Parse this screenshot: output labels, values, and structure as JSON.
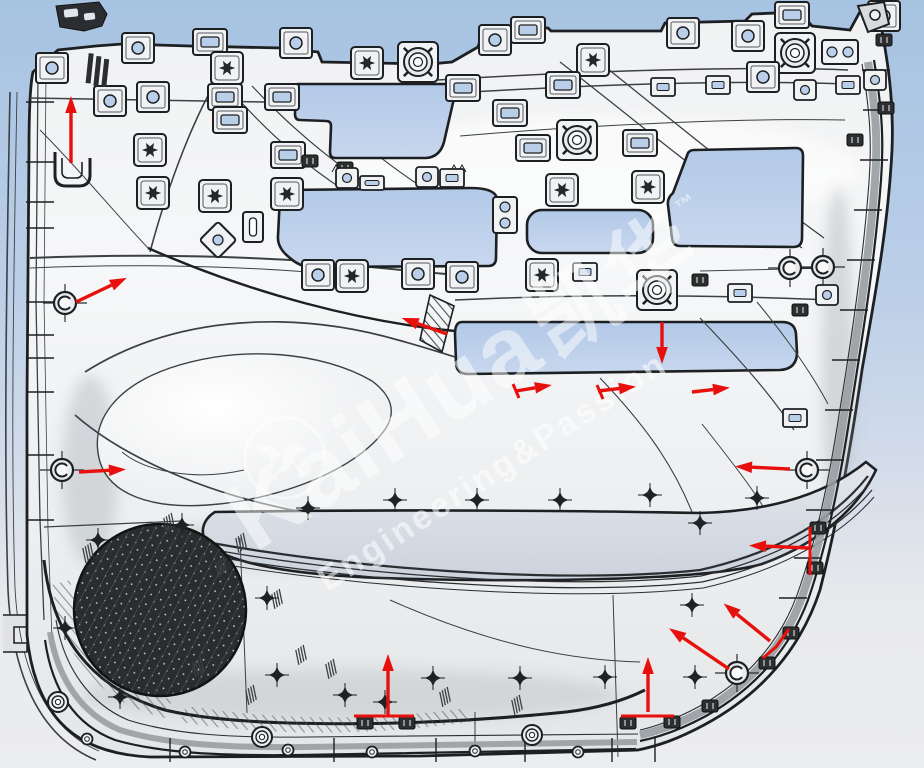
{
  "canvas": {
    "width": 924,
    "height": 768
  },
  "colors": {
    "background_top": "#a6c3e2",
    "background_mid": "#bccfe8",
    "background_bottom": "#ebecee",
    "panel_light": "#f5f6f7",
    "panel_mid": "#e6e8ea",
    "line_dark": "#1d2023",
    "line_mid": "#3c4043",
    "cutout_blue_top": "#b2c9e7",
    "cutout_blue_bottom": "#c8d7ee",
    "pocket_gray": "#dde2e9",
    "arrow_red": "#e8100c",
    "rim_gray": "#989da2",
    "speaker_dark": "#2a2c2e",
    "watermark_white": "#ffffff",
    "clip_blue": "#b9cfe9"
  },
  "watermark": {
    "brand_latin": "KaiHua",
    "brand_cjk": "凯华",
    "trademark": "™",
    "tagline": "Engineering&Passion",
    "logo_name": "hummingbird-logo"
  },
  "drawing": {
    "type": "cad-door-trim-panel-rear-view",
    "speaker": {
      "cx": 160,
      "cy": 610,
      "r": 86
    },
    "arrows": [
      [
        71,
        163,
        71,
        108
      ],
      [
        76,
        302,
        116,
        283
      ],
      [
        79,
        472,
        114,
        470
      ],
      [
        447,
        334,
        413,
        322
      ],
      [
        662,
        322,
        662,
        352
      ],
      [
        516,
        391,
        540,
        387
      ],
      [
        598,
        391,
        624,
        388
      ],
      [
        692,
        392,
        718,
        389
      ],
      [
        790,
        469,
        747,
        467
      ],
      [
        809,
        548,
        761,
        546
      ],
      [
        770,
        641,
        733,
        611
      ],
      [
        729,
        669,
        679,
        635
      ],
      [
        648,
        712,
        648,
        669
      ],
      [
        388,
        716,
        388,
        666
      ]
    ],
    "red_marks": [
      [
        354,
        716,
        414,
        716
      ],
      [
        621,
        716,
        674,
        716
      ],
      [
        810,
        527,
        810,
        575
      ],
      [
        513,
        384,
        519,
        398
      ],
      [
        597,
        385,
        603,
        399
      ]
    ],
    "red_arc": [
      763,
      658,
      776,
      647,
      789,
      629
    ],
    "clips": [
      [
        52,
        68,
        "c"
      ],
      [
        138,
        48,
        "c"
      ],
      [
        210,
        42,
        "r"
      ],
      [
        296,
        43,
        "c"
      ],
      [
        367,
        63,
        "s"
      ],
      [
        418,
        62,
        "t"
      ],
      [
        495,
        40,
        "c"
      ],
      [
        528,
        30,
        "r"
      ],
      [
        593,
        60,
        "s"
      ],
      [
        683,
        33,
        "c"
      ],
      [
        748,
        36,
        "c"
      ],
      [
        792,
        15,
        "r"
      ],
      [
        795,
        53,
        "t"
      ],
      [
        840,
        52,
        "2h"
      ],
      [
        884,
        16,
        "c"
      ],
      [
        110,
        101,
        "c"
      ],
      [
        153,
        97,
        "c"
      ],
      [
        227,
        68,
        "s"
      ],
      [
        225,
        97,
        "r"
      ],
      [
        282,
        97,
        "r"
      ],
      [
        463,
        88,
        "r"
      ],
      [
        563,
        85,
        "r"
      ],
      [
        663,
        87,
        "r2"
      ],
      [
        718,
        85,
        "r2"
      ],
      [
        763,
        77,
        "c"
      ],
      [
        805,
        90,
        "c2"
      ],
      [
        848,
        85,
        "r2"
      ],
      [
        875,
        80,
        "c2"
      ],
      [
        150,
        150,
        "s"
      ],
      [
        230,
        120,
        "r"
      ],
      [
        288,
        155,
        "r"
      ],
      [
        310,
        161,
        "f"
      ],
      [
        345,
        168,
        "f"
      ],
      [
        510,
        113,
        "r"
      ],
      [
        533,
        148,
        "r"
      ],
      [
        577,
        140,
        "t"
      ],
      [
        640,
        143,
        "r"
      ],
      [
        153,
        193,
        "s"
      ],
      [
        215,
        196,
        "s"
      ],
      [
        287,
        194,
        "s"
      ],
      [
        562,
        190,
        "s"
      ],
      [
        648,
        187,
        "s"
      ],
      [
        253,
        227,
        "slotV"
      ],
      [
        218,
        240,
        "d"
      ],
      [
        505,
        215,
        "2v"
      ],
      [
        347,
        178,
        "c2"
      ],
      [
        372,
        183,
        "slotH"
      ],
      [
        427,
        177,
        "c2"
      ],
      [
        452,
        178,
        "r2"
      ],
      [
        318,
        275,
        "c"
      ],
      [
        352,
        276,
        "s"
      ],
      [
        418,
        274,
        "c"
      ],
      [
        462,
        277,
        "c"
      ],
      [
        542,
        275,
        "s"
      ],
      [
        585,
        272,
        "r2"
      ],
      [
        657,
        290,
        "t"
      ],
      [
        740,
        293,
        "r2"
      ],
      [
        700,
        280,
        "f"
      ],
      [
        827,
        295,
        "c2"
      ],
      [
        800,
        310,
        "f"
      ],
      [
        795,
        418,
        "r2"
      ],
      [
        818,
        528,
        "f"
      ],
      [
        815,
        568,
        "f"
      ],
      [
        855,
        140,
        "f"
      ],
      [
        884,
        40,
        "f"
      ],
      [
        886,
        108,
        "f"
      ],
      [
        791,
        633,
        "f"
      ],
      [
        767,
        663,
        "f"
      ],
      [
        710,
        706,
        "f"
      ],
      [
        365,
        723,
        "f"
      ],
      [
        407,
        723,
        "f"
      ],
      [
        628,
        723,
        "f"
      ],
      [
        672,
        722,
        "f"
      ],
      [
        65,
        303,
        "g"
      ],
      [
        62,
        470,
        "g"
      ],
      [
        807,
        470,
        "g"
      ],
      [
        737,
        673,
        "g"
      ],
      [
        790,
        268,
        "g"
      ],
      [
        823,
        267,
        "g"
      ]
    ],
    "screw_bosses": [
      [
        98,
        540
      ],
      [
        182,
        525
      ],
      [
        65,
        628
      ],
      [
        120,
        697
      ],
      [
        267,
        598
      ],
      [
        277,
        675
      ],
      [
        308,
        508
      ],
      [
        395,
        500
      ],
      [
        477,
        500
      ],
      [
        560,
        500
      ],
      [
        650,
        495
      ],
      [
        433,
        678
      ],
      [
        520,
        678
      ],
      [
        605,
        677
      ],
      [
        345,
        695
      ],
      [
        692,
        605
      ],
      [
        695,
        677
      ],
      [
        757,
        498
      ],
      [
        700,
        523
      ],
      [
        385,
        702
      ]
    ],
    "bottom_fasteners": [
      [
        58,
        702,
        "L"
      ],
      [
        262,
        737,
        "L"
      ],
      [
        532,
        735,
        "L"
      ],
      [
        87,
        739,
        "S"
      ],
      [
        185,
        752,
        "S"
      ],
      [
        288,
        750,
        "S"
      ],
      [
        372,
        752,
        "S"
      ],
      [
        475,
        751,
        "S"
      ],
      [
        578,
        752,
        "S"
      ]
    ],
    "hatch_marks": [
      [
        95,
        548
      ],
      [
        176,
        518
      ],
      [
        228,
        562
      ],
      [
        284,
        594
      ],
      [
        308,
        650
      ],
      [
        258,
        690
      ],
      [
        338,
        664
      ],
      [
        452,
        692
      ],
      [
        524,
        700
      ],
      [
        205,
        662
      ],
      [
        248,
        538
      ]
    ]
  }
}
